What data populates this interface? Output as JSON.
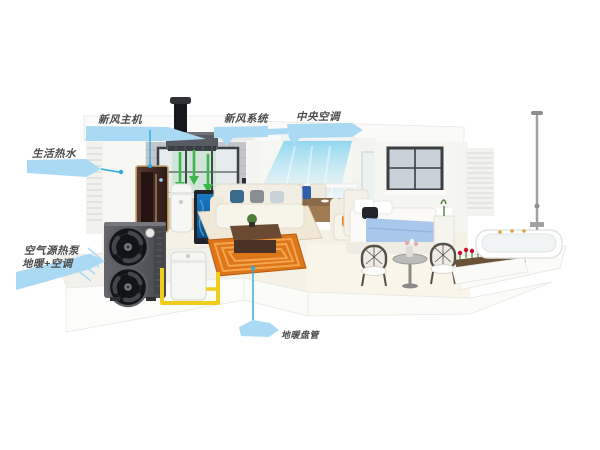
{
  "illustration": {
    "callouts": {
      "fresh_air_unit": {
        "label": "新风主机"
      },
      "fresh_air_system": {
        "label": "新风系统"
      },
      "central_ac": {
        "label": "中央空调"
      },
      "hot_water": {
        "label": "生活热水"
      },
      "heat_pump": {
        "line1": "空气源热泵",
        "line2": "地暖+空调"
      },
      "floor_heating": {
        "label": "地暖盘管"
      }
    },
    "colors": {
      "background": "#ffffff",
      "callout_fill": "#a9d9f3",
      "callout_text": "#4c4c4e",
      "leader_line": "#29abe2",
      "pipe_yellow": "#f0cd1a",
      "floor_coil": "#dd7619",
      "floor_coil_loop": "#f5a54d",
      "fresh_air_green": "#3cb54a",
      "ac_air_cyan": "#7fd2ef",
      "heat_pump_body": "#54565c",
      "bed_blue": "#a9c7ea",
      "flower_red": "#c8102e",
      "cabinet_gold": "#c9a96e"
    }
  }
}
